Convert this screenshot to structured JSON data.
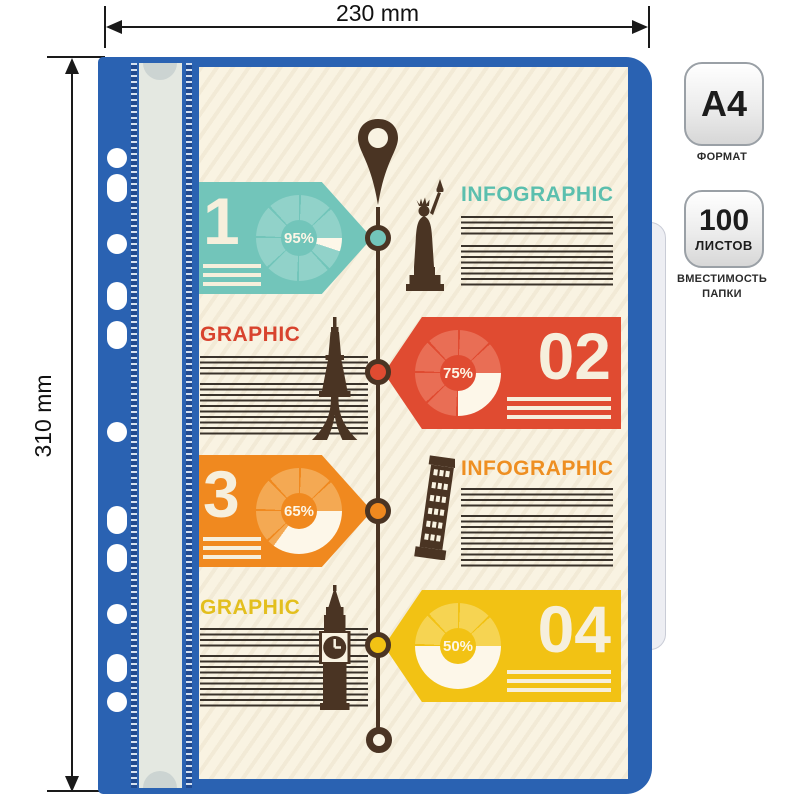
{
  "dimension_labels": {
    "width": "230 mm",
    "height": "310 mm"
  },
  "spec_badges": {
    "format": {
      "value": "A4",
      "caption": "ФОРМАТ"
    },
    "capacity": {
      "value": "100",
      "unit": "ЛИСТОВ",
      "caption": "ВМЕСТИМОСТЬ ПАПКИ"
    }
  },
  "folder": {
    "colors": {
      "body_blue": "#2a62b2",
      "cover_cream": "#f9f3e2",
      "clamp_bar_gray": "#e4e8e1",
      "back_tab_gray": "#edeef3",
      "timeline_brown": "#4a3423",
      "text_line_brown": "#3a332b"
    },
    "infographic": {
      "items": [
        {
          "number": "1",
          "percent": "95%",
          "percent_value": 95,
          "heading": "INFOGRAPHIC",
          "icon": "statue-of-liberty",
          "color": "#72c5ba",
          "color_light": "#91d2c9",
          "heading_color": "#5bbfae",
          "direction": "right"
        },
        {
          "number": "02",
          "percent": "75%",
          "percent_value": 75,
          "heading": "GRAPHIC",
          "icon": "eiffel-tower",
          "color": "#e04b31",
          "color_light": "#e96e55",
          "heading_color": "#d8432e",
          "direction": "left"
        },
        {
          "number": "3",
          "percent": "65%",
          "percent_value": 65,
          "heading": "INFOGRAPHIC",
          "icon": "pisa-tower",
          "color": "#f0891f",
          "color_light": "#f4a953",
          "heading_color": "#ee8f22",
          "direction": "right"
        },
        {
          "number": "04",
          "percent": "50%",
          "percent_value": 50,
          "heading": "GRAPHIC",
          "icon": "big-ben",
          "color": "#f2c214",
          "color_light": "#f6d452",
          "heading_color": "#e3bf1e",
          "direction": "left"
        }
      ],
      "timeline_icons": [
        "map-pin-icon",
        "timeline-end-ring-icon"
      ]
    },
    "spine": {
      "punch_hole_count": 11
    }
  }
}
